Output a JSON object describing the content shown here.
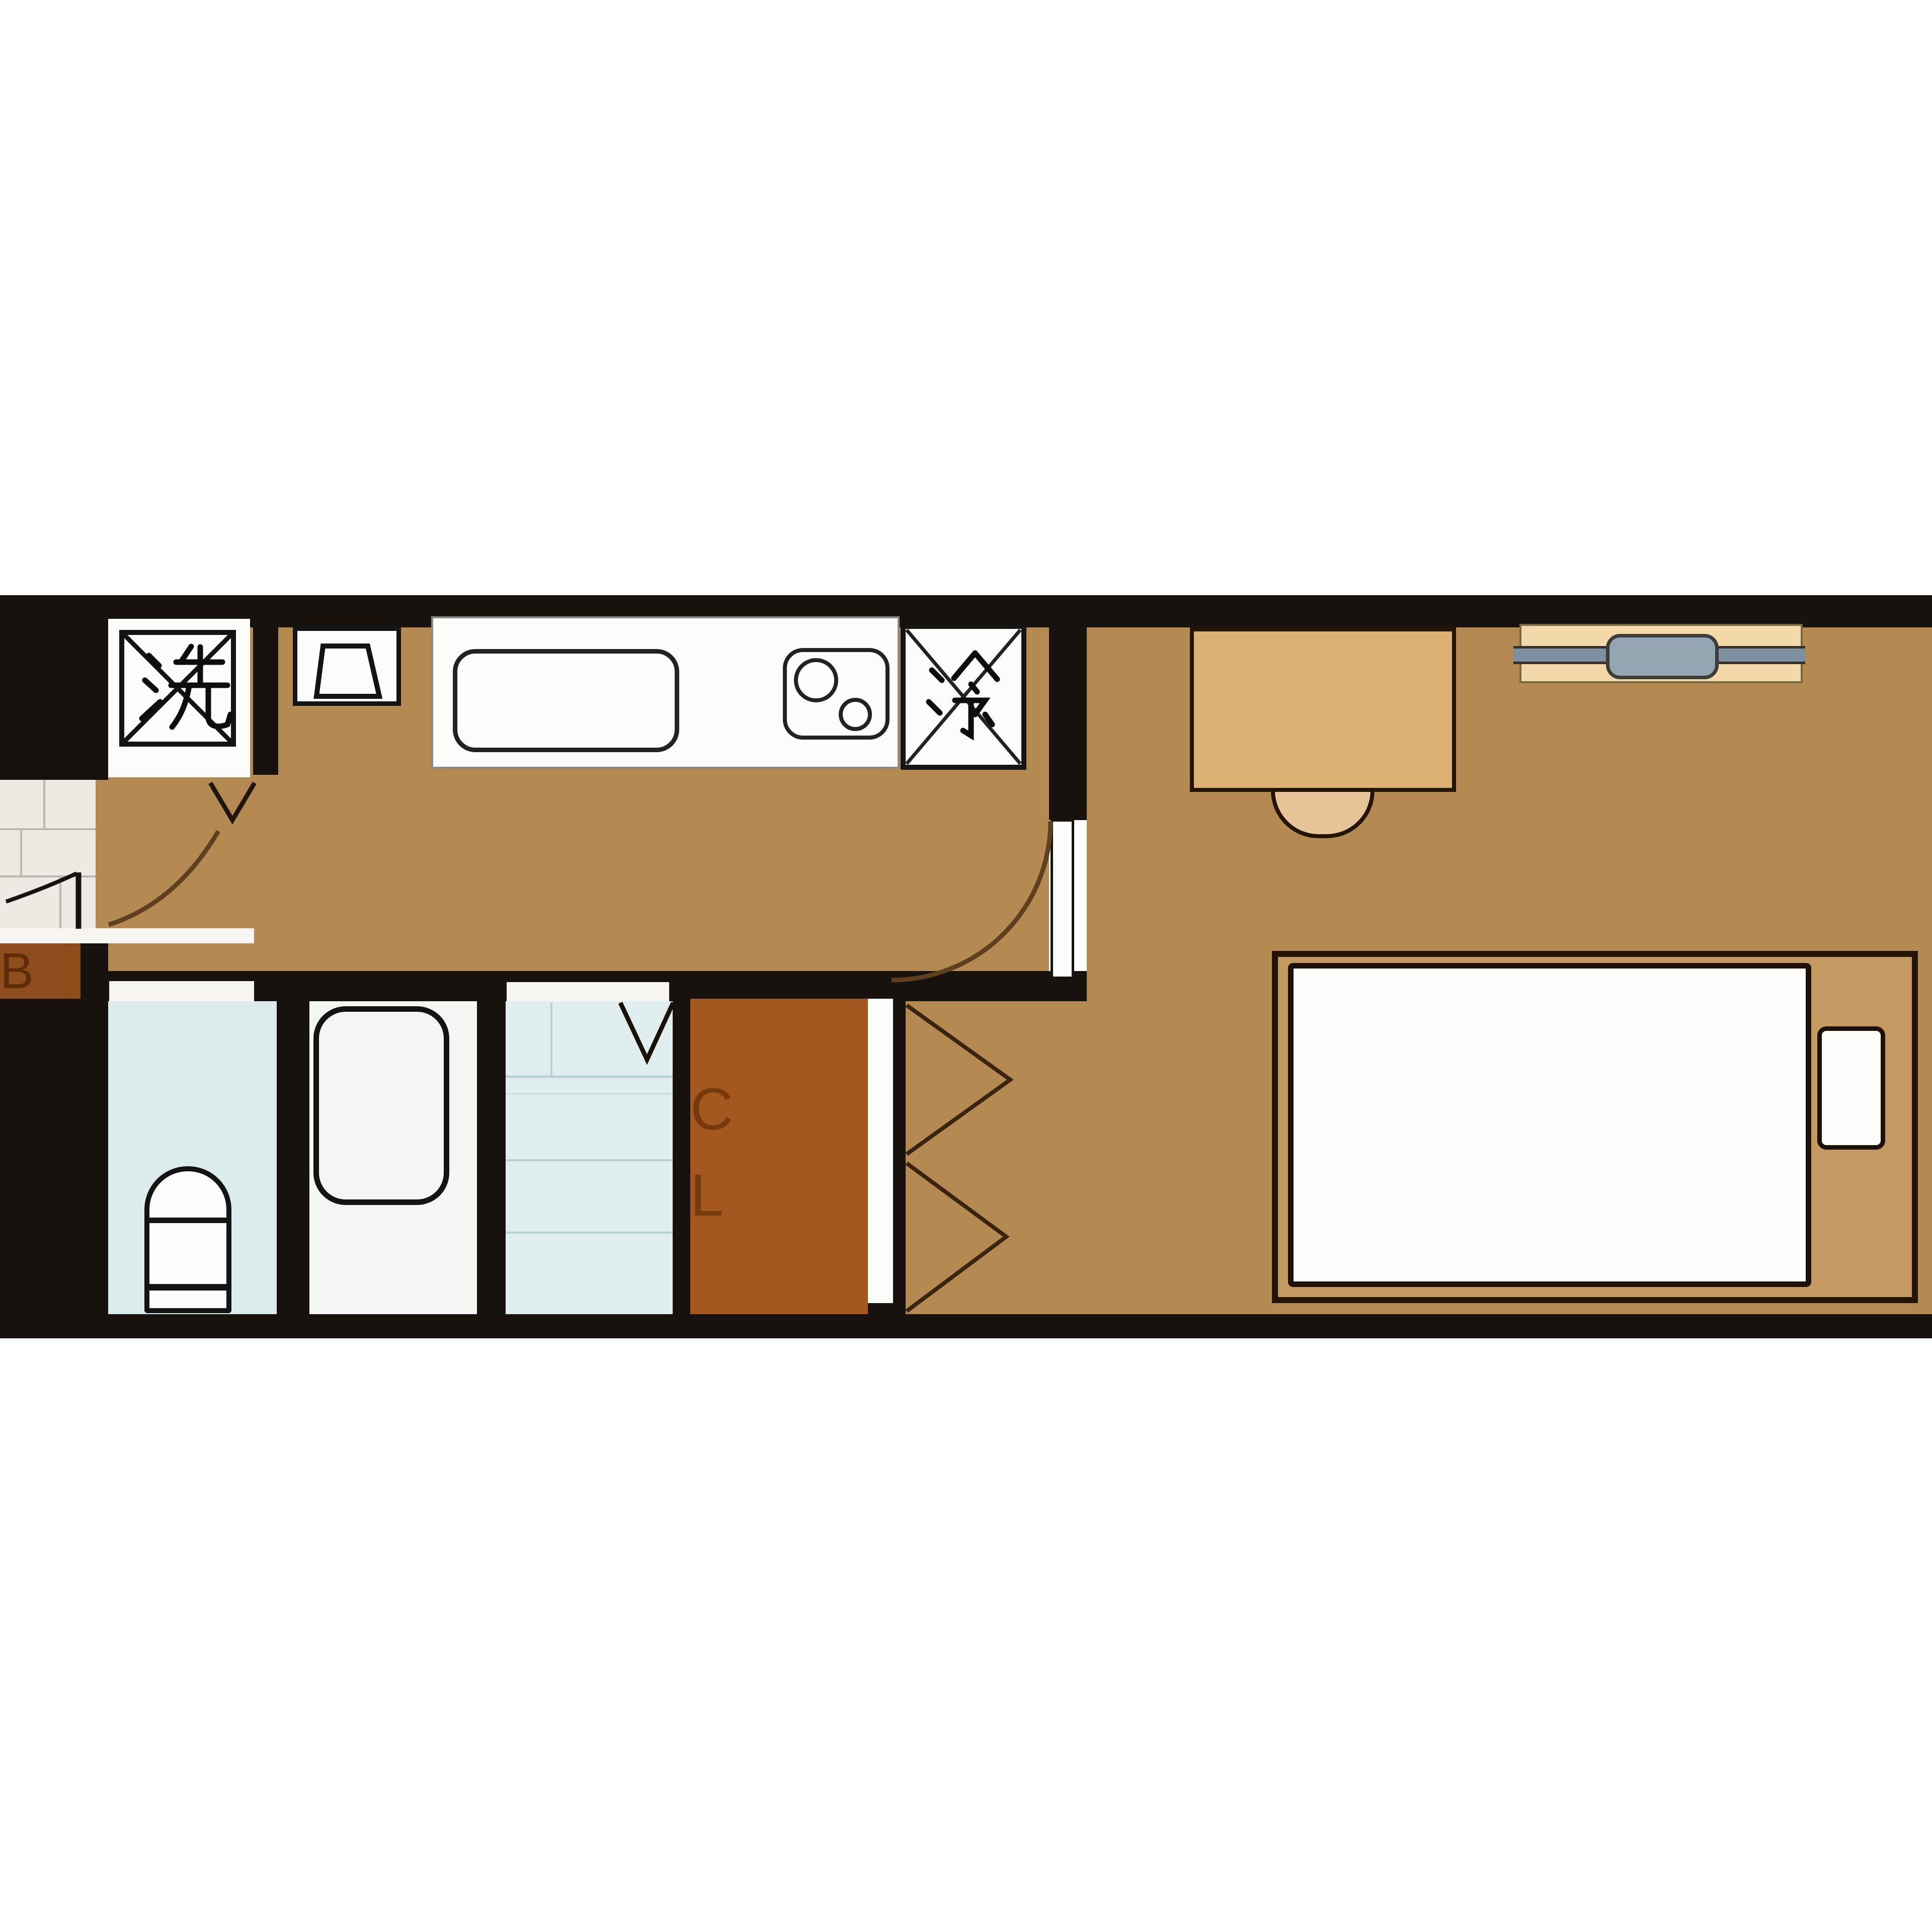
{
  "floorplan": {
    "labels": {
      "washer": "洗",
      "refrigerator": "冷",
      "closet_top": "C",
      "closet_bottom": "L",
      "shoe_box": "B"
    },
    "colors": {
      "wall": "#17120d",
      "floor": "#b48a52",
      "tile": "#edeae3",
      "step": "#f6f5f2",
      "blue_room": "#dcebec",
      "bath_room": "#f4f6f3",
      "wash_room": "#e0eef0",
      "rust": "#a4571f",
      "letter": "#6b3208",
      "white_fix": "#fcfcfa",
      "desk": "#ddb074",
      "chair": "#e6c498",
      "bed_frame": "#c59a62",
      "outline": "#241403",
      "ac_body": "#f3d9a9",
      "ac_bar": "#7e90a0",
      "ac_cap": "#93a6b2",
      "arc": "#5e4020",
      "ink": "#141414",
      "tile_line": "#bcb8af",
      "wash_line": "#b8d3d6"
    }
  }
}
